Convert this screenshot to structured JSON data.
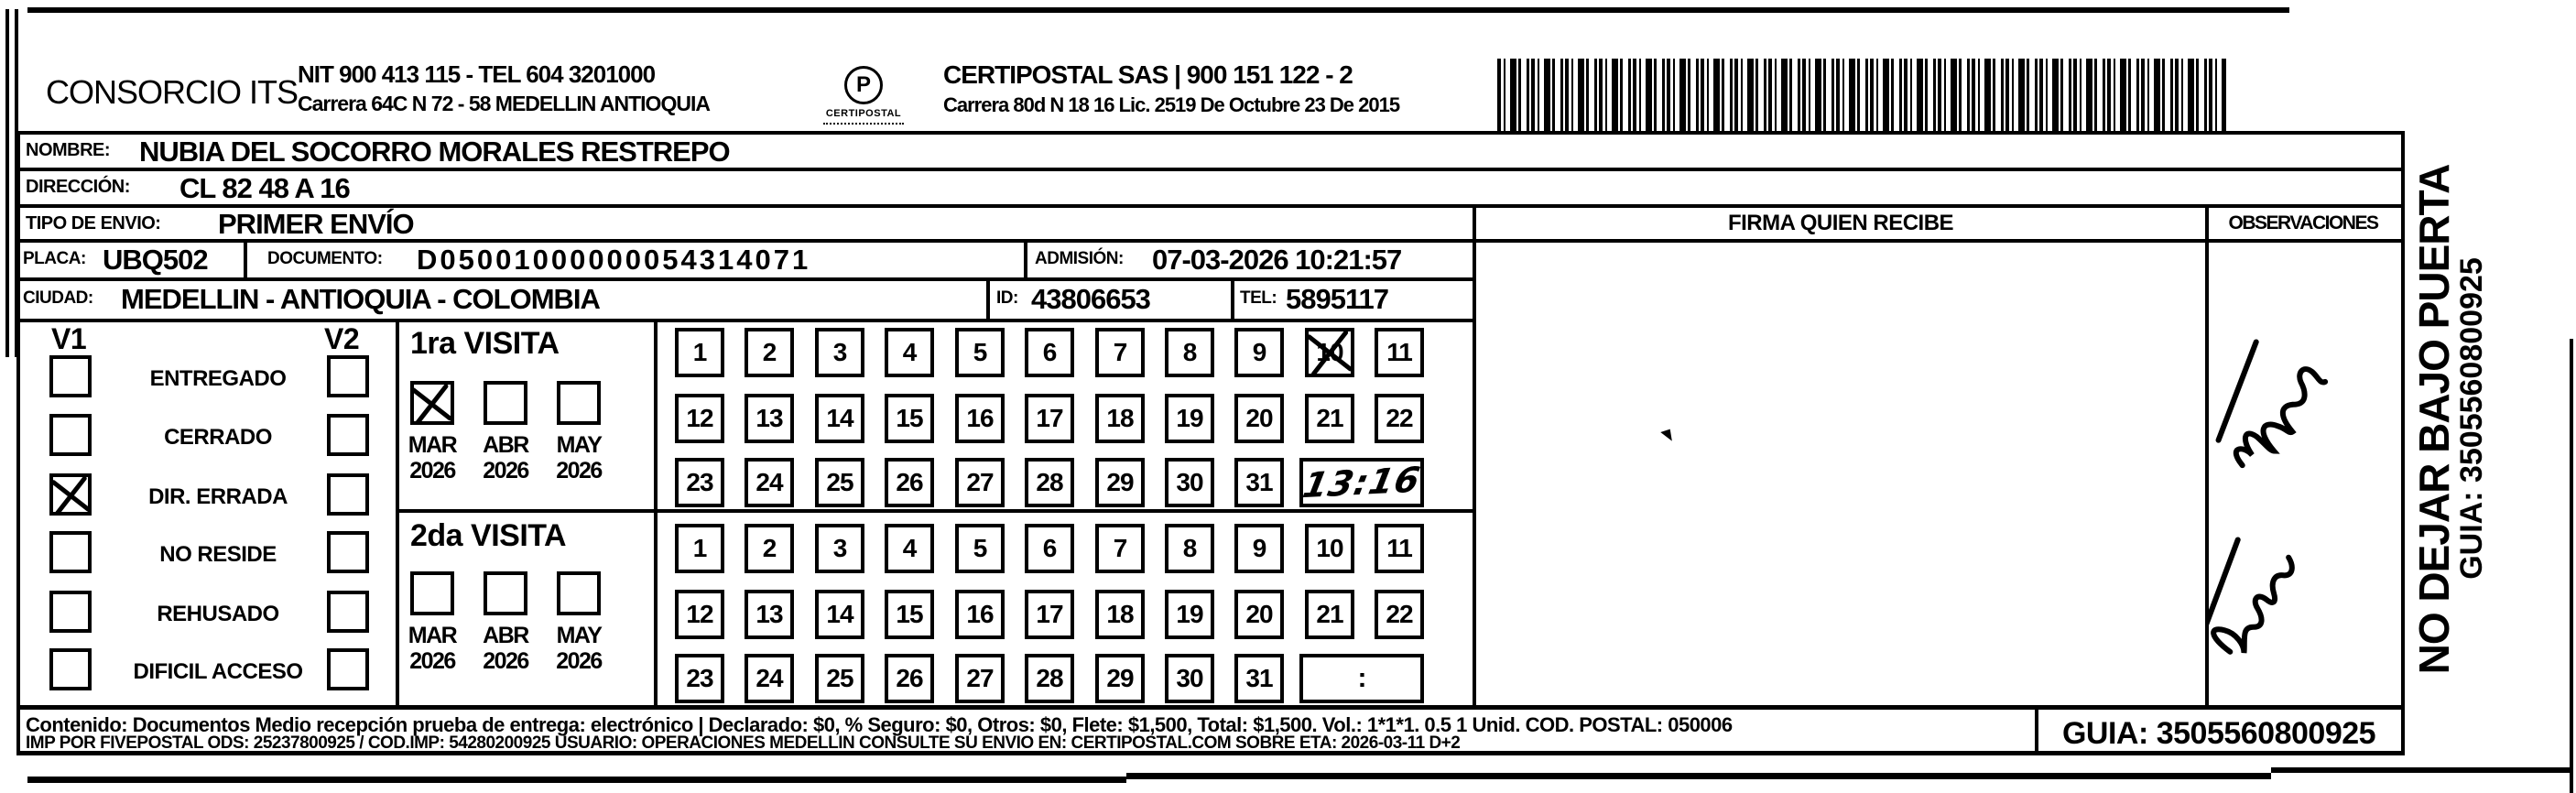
{
  "header": {
    "company_left": "CONSORCIO ITS",
    "left_line1": "NIT 900 413 115 - TEL 604 3201000",
    "left_line2": "Carrera 64C N 72 - 58 MEDELLIN ANTIOQUIA",
    "logo_letter": "P",
    "logo_text": "CERTIPOSTAL",
    "right_line1": "CERTIPOSTAL SAS | 900 151 122 - 2",
    "right_line2": "Carrera 80d N 18 16  Lic. 2519 De Octubre 23 De 2015"
  },
  "form": {
    "nombre_label": "NOMBRE:",
    "nombre": "NUBIA DEL SOCORRO MORALES RESTREPO",
    "direccion_label": "DIRECCIÓN:",
    "direccion": "CL 82 48 A 16",
    "tipo_label": "TIPO DE ENVIO:",
    "tipo": "PRIMER ENVÍO",
    "placa_label": "PLACA:",
    "placa": "UBQ502",
    "documento_label": "DOCUMENTO:",
    "documento": "D05001000000054314071",
    "admision_label": "ADMISIÓN:",
    "admision": "07-03-2026 10:21:57",
    "ciudad_label": "CIUDAD:",
    "ciudad": "MEDELLIN - ANTIOQUIA - COLOMBIA",
    "id_label": "ID:",
    "id": "43806653",
    "tel_label": "TEL:",
    "tel": "5895117"
  },
  "firma": {
    "header": "FIRMA QUIEN RECIBE"
  },
  "observaciones": {
    "header": "OBSERVACIONES",
    "handwritten_note": "feuia ApT6 (illegible handwritten note, two diagonal cursive lines)"
  },
  "status": {
    "v1_label": "V1",
    "v2_label": "V2",
    "options": [
      {
        "label": "ENTREGADO",
        "v1": false,
        "v2": false
      },
      {
        "label": "CERRADO",
        "v1": false,
        "v2": false
      },
      {
        "label": "DIR. ERRADA",
        "v1": true,
        "v2": false
      },
      {
        "label": "NO RESIDE",
        "v1": false,
        "v2": false
      },
      {
        "label": "REHUSADO",
        "v1": false,
        "v2": false
      },
      {
        "label": "DIFICIL ACCESO",
        "v1": false,
        "v2": false
      }
    ]
  },
  "visita1": {
    "title": "1ra VISITA",
    "months": [
      {
        "label": "MAR",
        "year": "2026",
        "checked": true
      },
      {
        "label": "ABR",
        "year": "2026",
        "checked": false
      },
      {
        "label": "MAY",
        "year": "2026",
        "checked": false
      }
    ],
    "days_rows": [
      [
        "1",
        "2",
        "3",
        "4",
        "5",
        "6",
        "7",
        "8",
        "9",
        "10",
        "11"
      ],
      [
        "12",
        "13",
        "14",
        "15",
        "16",
        "17",
        "18",
        "19",
        "20",
        "21",
        "22"
      ],
      [
        "23",
        "24",
        "25",
        "26",
        "27",
        "28",
        "29",
        "30",
        "31"
      ]
    ],
    "crossed_day": "10",
    "time": "13:16"
  },
  "visita2": {
    "title": "2da VISITA",
    "months": [
      {
        "label": "MAR",
        "year": "2026",
        "checked": false
      },
      {
        "label": "ABR",
        "year": "2026",
        "checked": false
      },
      {
        "label": "MAY",
        "year": "2026",
        "checked": false
      }
    ],
    "days_rows": [
      [
        "1",
        "2",
        "3",
        "4",
        "5",
        "6",
        "7",
        "8",
        "9",
        "10",
        "11"
      ],
      [
        "12",
        "13",
        "14",
        "15",
        "16",
        "17",
        "18",
        "19",
        "20",
        "21",
        "22"
      ],
      [
        "23",
        "24",
        "25",
        "26",
        "27",
        "28",
        "29",
        "30",
        "31"
      ]
    ],
    "crossed_day": null,
    "time": ":"
  },
  "footer": {
    "line1": "Contenido: Documentos Medio recepción prueba de entrega: electrónico | Declarado: $0, % Seguro: $0, Otros: $0, Flete: $1,500, Total: $1,500. Vol.: 1*1*1. 0.5  1 Unid. COD. POSTAL: 050006",
    "line2": "IMP POR FIVEPOSTAL ODS: 25237800925 / COD.IMP: 54280200925 USUARIO: OPERACIONES MEDELLIN CONSULTE SU ENVIO EN: CERTIPOSTAL.COM SOBRE ETA: 2026-03-11 D+2",
    "guia": "GUIA: 3505560800925"
  },
  "side": {
    "warning": "NO DEJAR BAJO PUERTA",
    "guia": "GUIA: 3505560800925"
  }
}
